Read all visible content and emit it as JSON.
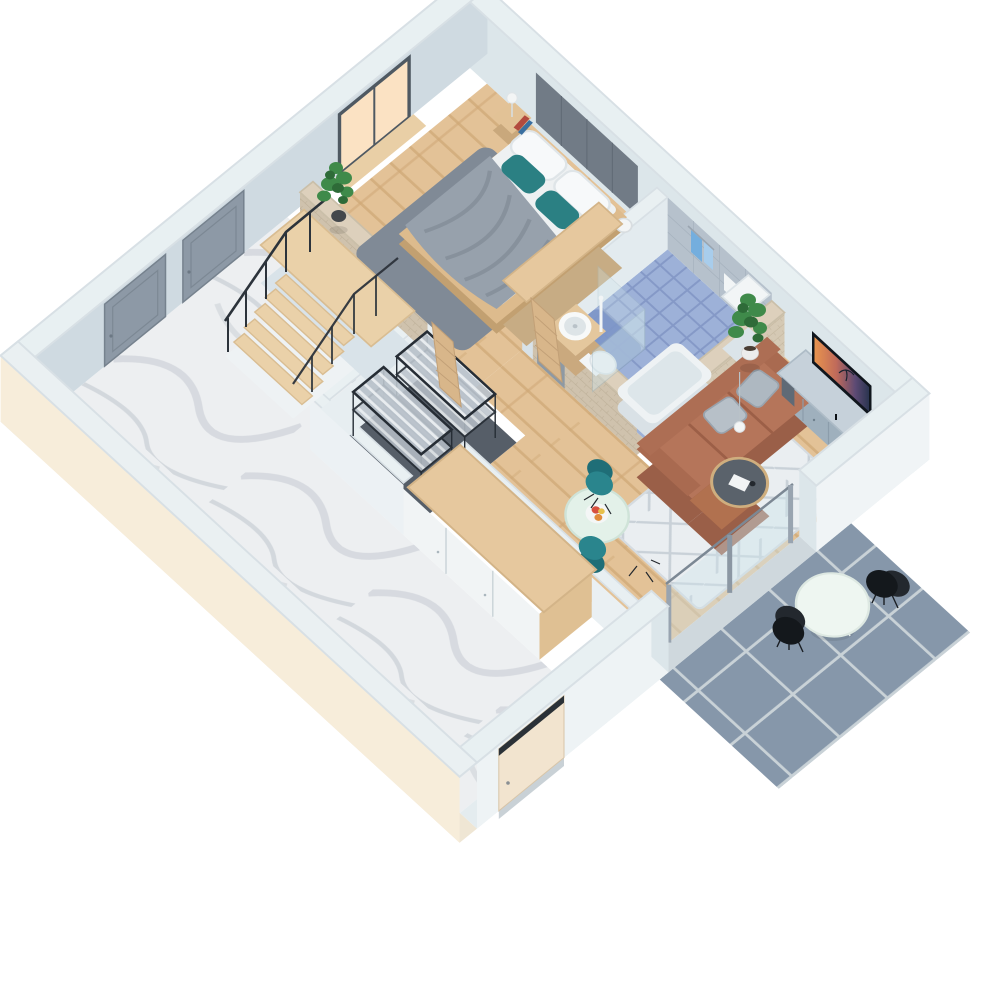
{
  "scene": {
    "description": "3D isometric floor plan render of a one-bedroom apartment with terrace",
    "view": "axonometric top-down render, rotated",
    "background": "#ffffff"
  },
  "rooms": [
    {
      "id": "bedroom",
      "name": "Bedroom",
      "floor": "light oak planks",
      "furniture": [
        "double bed",
        "gray duvet",
        "white pillows",
        "teal accent pillows",
        "upholstered headboard panel",
        "nightstand",
        "table lamp",
        "books",
        "gray area rug",
        "wooden wardrobe",
        "potted plant",
        "white vase",
        "window with warm light",
        "wooden window sill"
      ]
    },
    {
      "id": "bathroom",
      "name": "Bathroom",
      "floor": "blue mosaic tile",
      "furniture": [
        "round basin on wooden vanity",
        "toilet",
        "walk-in shower with glass screen",
        "bathtub",
        "towel rail with blue towels",
        "tall white cabinet",
        "gray wall tiles",
        "wooden slat door",
        "brick half walls"
      ]
    },
    {
      "id": "living",
      "name": "Living / Dining room",
      "floor": "light oak planks",
      "furniture": [
        "brown leather corner sofa",
        "gray sofa cushions",
        "geometric white rug",
        "round coffee table",
        "pendant lamp",
        "magazine",
        "TV media console",
        "curved TV",
        "round dining table",
        "fruit bowl",
        "two teal armchairs",
        "potted plant",
        "sliding glass doors"
      ]
    },
    {
      "id": "hallway",
      "name": "Hallway / Staircase",
      "floor": "white marble",
      "furniture": [
        "wooden staircase",
        "stair landing",
        "black metal railing",
        "two gray interior doors",
        "entrance door"
      ]
    },
    {
      "id": "storage",
      "name": "Storage room",
      "floor": "dark gray",
      "furniture": [
        "two black wire shelving units",
        "leaning wooden door"
      ]
    },
    {
      "id": "corridor",
      "name": "Bottom corridor",
      "floor": "white marble",
      "furniture": [
        "wardrobe run with white fronts and wooden top"
      ]
    },
    {
      "id": "terrace",
      "name": "Terrace (outdoor)",
      "floor": "blue-gray outdoor tiles",
      "furniture": [
        "round white bistro table",
        "two black chairs"
      ]
    }
  ],
  "palette": {
    "background": "#ffffff",
    "wallTop": "#e8f0f2",
    "wallFaceNE": "#dce6ea",
    "wallFaceNW": "#cfdae1",
    "wallFaceBright": "#f0f4f6",
    "wallFaceSoft": "#e7eef1",
    "wallFootprint": "#dfe8ec",
    "exteriorCream": "#f7edda",
    "floorWood": "#e3c297",
    "floorWoodLine": "#cfa877",
    "floorMarble": "#edeff1",
    "floorMarbleVein": "#d5d9de",
    "bathTile": "#9db1d8",
    "bathTileLine": "#8599c7",
    "showerBlue": "#7d96c8",
    "tileWallGray": "#b6c1cc",
    "storageFloor": "#565e68",
    "terraceTile": "#8697aa",
    "terraceGrout": "#c9d2d7",
    "brick": "#cfc2ad",
    "brickLine": "#b9ab93",
    "brickTop": "#ddd0bc",
    "headboard": "#717b86",
    "headboardSeam": "#626c77",
    "duvetGray": "#97a1ac",
    "duvetFold": "#87919c",
    "linenWhite": "#eef1f2",
    "pillowWhite": "#f7f9fa",
    "pillowTeal": "#2b8083",
    "rugBedroom": "#808a96",
    "bedWood": "#ddbb8d",
    "bedWoodDark": "#c2a071",
    "nightstandWood": "#e2c296",
    "lampWhite": "#f3f5f5",
    "bookRed": "#b24a3e",
    "bookBlue": "#3a6fa0",
    "plantGreen": "#3f8a4a",
    "plantGreenDark": "#2e6b38",
    "potDark": "#43474b",
    "potWhite": "#ececec",
    "vanityWood": "#e4c79d",
    "basinWhite": "#f7f9f9",
    "toiletWhite": "#f2f5f6",
    "tubWhite": "#eef2f4",
    "tubInner": "#dde6ea",
    "towelBlue": "#74aede",
    "towelLight": "#a8cdec",
    "glassBlue": "#cfe4ea",
    "doorGray": "#8d99a6",
    "doorGrayEdge": "#76828e",
    "doorWoodSlat": "#d8b68a",
    "windowGlow": "#fbe2c3",
    "frameDark": "#4f5962",
    "sillWood": "#e9cfa6",
    "stairWood": "#ead1a9",
    "landingSide": "#d9e3e9",
    "stepWhite": "#eef2f4",
    "railBlack": "#2c333b",
    "shelfFrame": "#262d35",
    "shelfWire": "#b9c2ca",
    "wardrobeTop": "#e6c89e",
    "wardrobeFront": "#f1f4f5",
    "wardrobeSide": "#dfc093",
    "wardrobeSeam": "#c9d3d8",
    "sofaBrown": "#b5755a",
    "sofaDark": "#9a5f48",
    "sofaBack": "#ad6e54",
    "sofaArm": "#a96a50",
    "sofaPillow": "#aeb8c1",
    "rugLiving": "#eaeef1",
    "rugLivingLine": "#c9d1d8",
    "coffeeTable": "#5a626b",
    "coffeeRim": "#cfae7e",
    "consoleTop": "#c6d1da",
    "consoleFace": "#9fb0bd",
    "tvFrame": "#10161d",
    "diningTable": "#e3f1e9",
    "tealChair": "#2a858d",
    "tealChairDark": "#1f6e77",
    "chairBlack": "#14181c",
    "chairBlackLight": "#23282e",
    "terraceTableTop": "#eef6f1",
    "entryDoor": "#f2e4cf",
    "lintelDark": "#2b3137"
  }
}
